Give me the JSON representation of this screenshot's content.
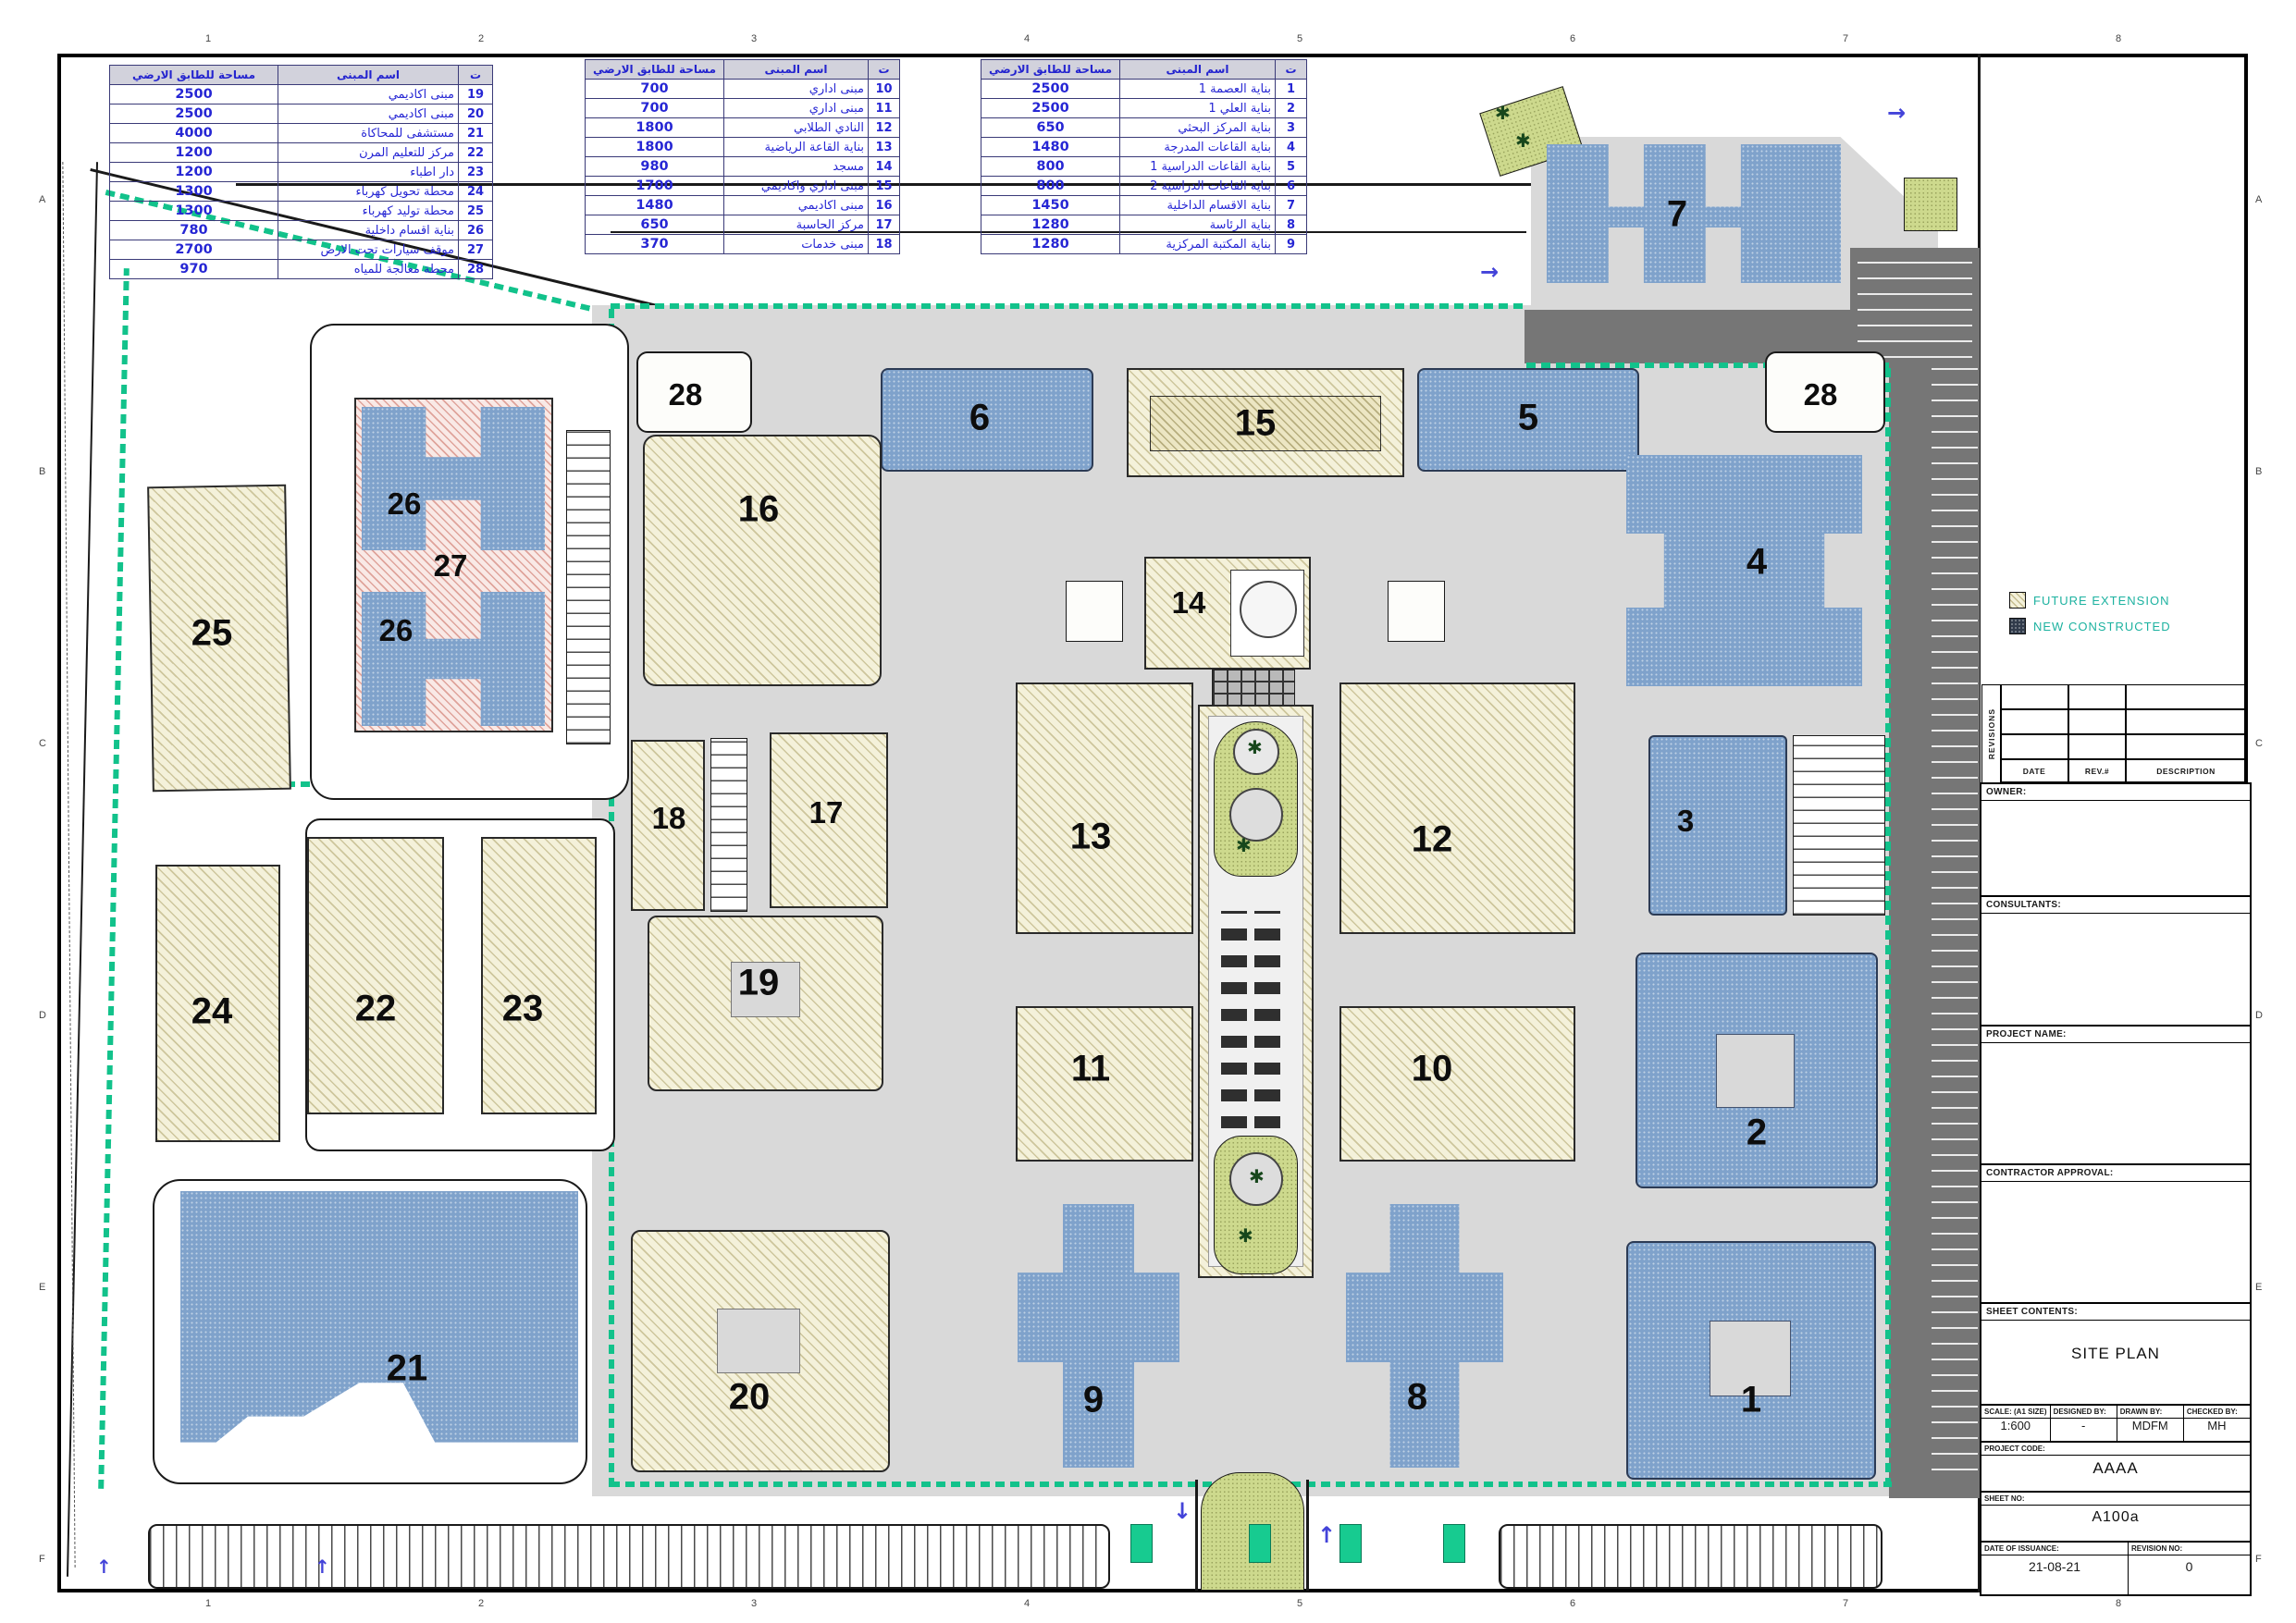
{
  "sheet": {
    "grid_top": [
      "1",
      "2",
      "3",
      "4",
      "5",
      "6",
      "7",
      "8"
    ],
    "grid_bottom": [
      "1",
      "2",
      "3",
      "4",
      "5",
      "6",
      "7",
      "8"
    ],
    "grid_left": [
      "A",
      "B",
      "C",
      "D",
      "E",
      "F"
    ],
    "grid_right": [
      "A",
      "B",
      "C",
      "D",
      "E",
      "F"
    ]
  },
  "legend_tables": [
    {
      "headers": [
        "ت",
        "اسم المبنى",
        "مساحة للطابق الارضي"
      ],
      "rows": [
        [
          "1",
          "بناية العصمة 1",
          "2500"
        ],
        [
          "2",
          "بناية العلي 1",
          "2500"
        ],
        [
          "3",
          "بناية المركز البحثي",
          "650"
        ],
        [
          "4",
          "بناية القاعات المدرجة",
          "1480"
        ],
        [
          "5",
          "بناية القاعات الدراسية 1",
          "800"
        ],
        [
          "6",
          "بناية القاعات الدراسية 2",
          "800"
        ],
        [
          "7",
          "بناية الاقسام الداخلية",
          "1450"
        ],
        [
          "8",
          "بناية الرئاسة",
          "1280"
        ],
        [
          "9",
          "بناية المكتبة المركزية",
          "1280"
        ]
      ]
    },
    {
      "headers": [
        "ت",
        "اسم المبنى",
        "مساحة للطابق الارضي"
      ],
      "rows": [
        [
          "10",
          "مبنى اداري",
          "700"
        ],
        [
          "11",
          "مبنى اداري",
          "700"
        ],
        [
          "12",
          "النادي الطلابي",
          "1800"
        ],
        [
          "13",
          "بناية القاعة الرياضية",
          "1800"
        ],
        [
          "14",
          "مسجد",
          "980"
        ],
        [
          "15",
          "مبنى اداري واكاديمي",
          "1700"
        ],
        [
          "16",
          "مبنى اكاديمي",
          "1480"
        ],
        [
          "17",
          "مركز الحاسبة",
          "650"
        ],
        [
          "18",
          "مبنى خدمات",
          "370"
        ]
      ]
    },
    {
      "headers": [
        "ت",
        "اسم المبنى",
        "مساحة للطابق الارضي"
      ],
      "rows": [
        [
          "19",
          "مبنى اكاديمي",
          "2500"
        ],
        [
          "20",
          "مبنى اكاديمي",
          "2500"
        ],
        [
          "21",
          "مستشفى للمحاكاة",
          "4000"
        ],
        [
          "22",
          "مركز للتعليم المرن",
          "1200"
        ],
        [
          "23",
          "دار اطباء",
          "1200"
        ],
        [
          "24",
          "محطة تحويل كهرباء",
          "1300"
        ],
        [
          "25",
          "محطة توليد كهرباء",
          "1300"
        ],
        [
          "26",
          "بناية اقسام داخلية",
          "780"
        ],
        [
          "27",
          "موقف سيارات تحت الارض",
          "2700"
        ],
        [
          "28",
          "محطة معالجة للمياه",
          "970"
        ]
      ]
    }
  ],
  "map_legend": {
    "future_extension": "FUTURE  EXTENSION",
    "new_constructed": "NEW  CONSTRUCTED",
    "future_color": "#f4f1da",
    "new_color": "#313b4b",
    "text_color": "#1db2a0"
  },
  "building_labels": {
    "b1": "1",
    "b2": "2",
    "b3": "3",
    "b4": "4",
    "b5": "5",
    "b6": "6",
    "b7": "7",
    "b8": "8",
    "b9": "9",
    "b10": "10",
    "b11": "11",
    "b12": "12",
    "b13": "13",
    "b14": "14",
    "b15": "15",
    "b16": "16",
    "b17": "17",
    "b18": "18",
    "b19": "19",
    "b20": "20",
    "b21": "21",
    "b22": "22",
    "b23": "23",
    "b24": "24",
    "b25": "25",
    "b26a": "26",
    "b26b": "26",
    "b27": "27",
    "b28a": "28",
    "b28b": "28"
  },
  "title_block": {
    "revisions_label": "REVISIONS",
    "date_label": "DATE",
    "rev_label": "REV.#",
    "description_label": "DESCRIPTION",
    "owner_label": "OWNER:",
    "consultants_label": "CONSULTANTS:",
    "project_name_label": "PROJECT NAME:",
    "contractor_label": "CONTRACTOR APPROVAL:",
    "sheet_contents_label": "SHEET CONTENTS:",
    "sheet_contents_value": "SITE PLAN",
    "scale_label": "SCALE: (A1 SIZE)",
    "scale_value": "1:600",
    "designed_label": "DESIGNED BY:",
    "designed_value": "-",
    "drawn_label": "DRAWN BY:",
    "drawn_value": "MDFM",
    "checked_label": "CHECKED BY:",
    "checked_value": "MH",
    "project_code_label": "PROJECT CODE:",
    "project_code_value": "AAAA",
    "sheet_no_label": "SHEET NO:",
    "sheet_no_value": "A100a",
    "date_of_issuance_label": "DATE OF ISSUANCE:",
    "date_of_issuance_value": "21-08-21",
    "revision_no_label": "REVISION NO:",
    "revision_no_value": "0"
  }
}
